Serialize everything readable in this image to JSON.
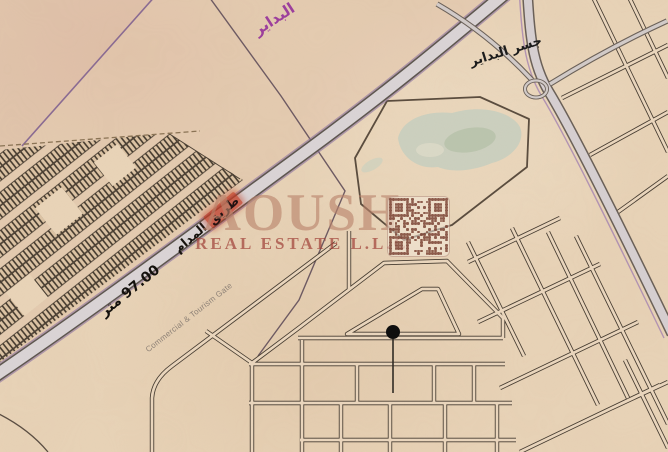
{
  "map": {
    "labels": {
      "region": "البداير",
      "bridge": "جسر البداير",
      "road_highlight": "طريق",
      "road_name": "المدام",
      "road_width": "97.00 متر",
      "gate": "Commercial & Tourism Gate"
    },
    "watermark": {
      "logo": "AOUSH",
      "subtitle": "REAL ESTATE L.L.C"
    },
    "colors": {
      "sand": "#e9d4b8",
      "road_fill": "#dad4d6",
      "road_edge": "#5d564f",
      "boundary_purple": "#8a6b93",
      "region_label": "#9c3f9c",
      "street": "#453b30",
      "highlight_red": "#c13b22",
      "watermark_red": "#9e3b33",
      "watermark_logo": "#b9836b",
      "pond_green": "#cad0bf",
      "marker_black": "#0d0d0d"
    }
  }
}
